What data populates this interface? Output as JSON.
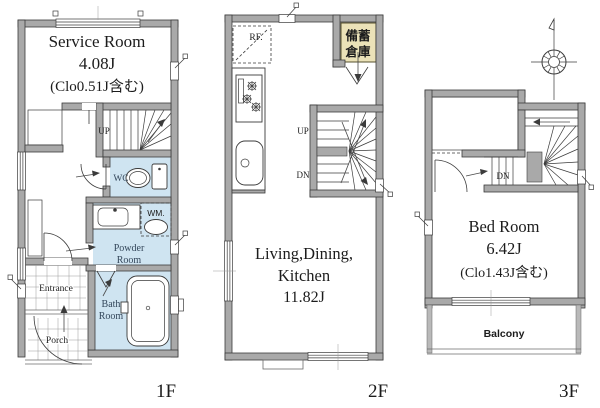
{
  "colors": {
    "wall_fill": "#a9a9a9",
    "wall_stroke": "#3b3b3b",
    "wet_area": "#cfe4f1",
    "closet": "#f0ebcf",
    "storage_box": "#ebe2b8",
    "ink": "#1c1c1c",
    "room_label_ink": "#33465a"
  },
  "floor_1f": {
    "label": "1F",
    "service_room": {
      "name": "Service Room",
      "size": "4.08J",
      "note": "(Clo0.51J含む)"
    },
    "stairs": {
      "up": "UP"
    },
    "wc": {
      "label": "WC"
    },
    "washing_machine": {
      "label": "WM."
    },
    "powder_room": {
      "line1": "Powder",
      "line2": "Room"
    },
    "bath_room": {
      "line1": "Bath",
      "line2": "Room"
    },
    "entrance": {
      "label": "Entrance"
    },
    "porch": {
      "label": "Porch"
    }
  },
  "floor_2f": {
    "label": "2F",
    "refrigerator": {
      "label": "RF."
    },
    "storage": {
      "line1": "備蓄",
      "line2": "倉庫"
    },
    "stairs": {
      "up": "UP",
      "down": "DN"
    },
    "ldk": {
      "line1": "Living,Dining,",
      "line2": "Kitchen",
      "size": "11.82J"
    }
  },
  "floor_3f": {
    "label": "3F",
    "stairs": {
      "down": "DN"
    },
    "bed_room": {
      "name": "Bed Room",
      "size": "6.42J",
      "note": "(Clo1.43J含む)"
    },
    "balcony": {
      "label": "Balcony"
    }
  }
}
